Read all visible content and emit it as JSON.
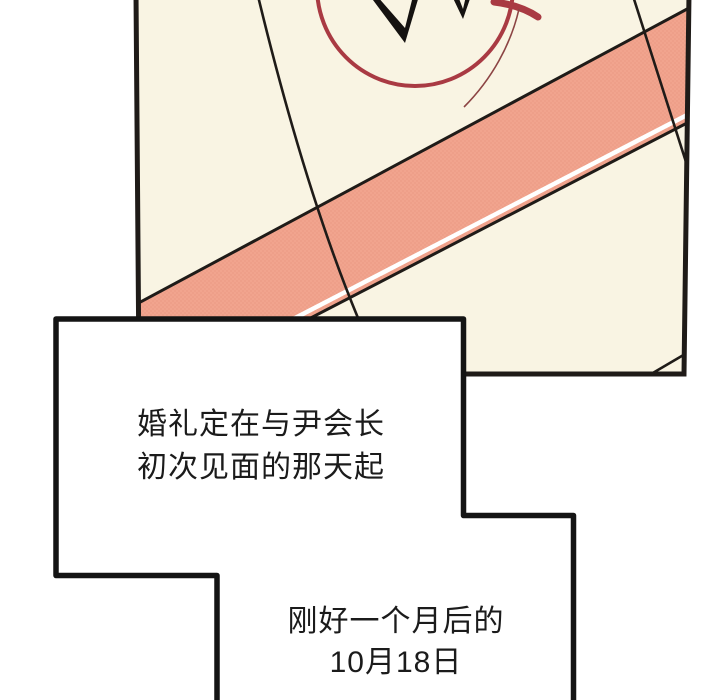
{
  "page": {
    "kind": "webtoon-comic-panel",
    "background_color": "#ffffff",
    "text_color": "#1b1b1b"
  },
  "panel": {
    "description": "close-up of a tilted calendar page with a circled date",
    "paper_color": "#F9F4E3",
    "ink_color": "#1f1b18",
    "stripe_color": "#F1A48E",
    "stripe_dot_color": "#E28F7A",
    "stripe_highlight_color": "#FFFFFF",
    "circle_mark_color": "#A93A43",
    "circle_tail_color": "#8C4444",
    "tick_color": "#151210"
  },
  "speech_bubble": {
    "fill_color": "#FFFFFF",
    "border_color": "#141414",
    "block1": {
      "line1": "婚礼定在与尹会长",
      "line2": "初次见面的那天起"
    },
    "block2": {
      "line1": "刚好一个月后的",
      "line2": "10月18日"
    }
  }
}
